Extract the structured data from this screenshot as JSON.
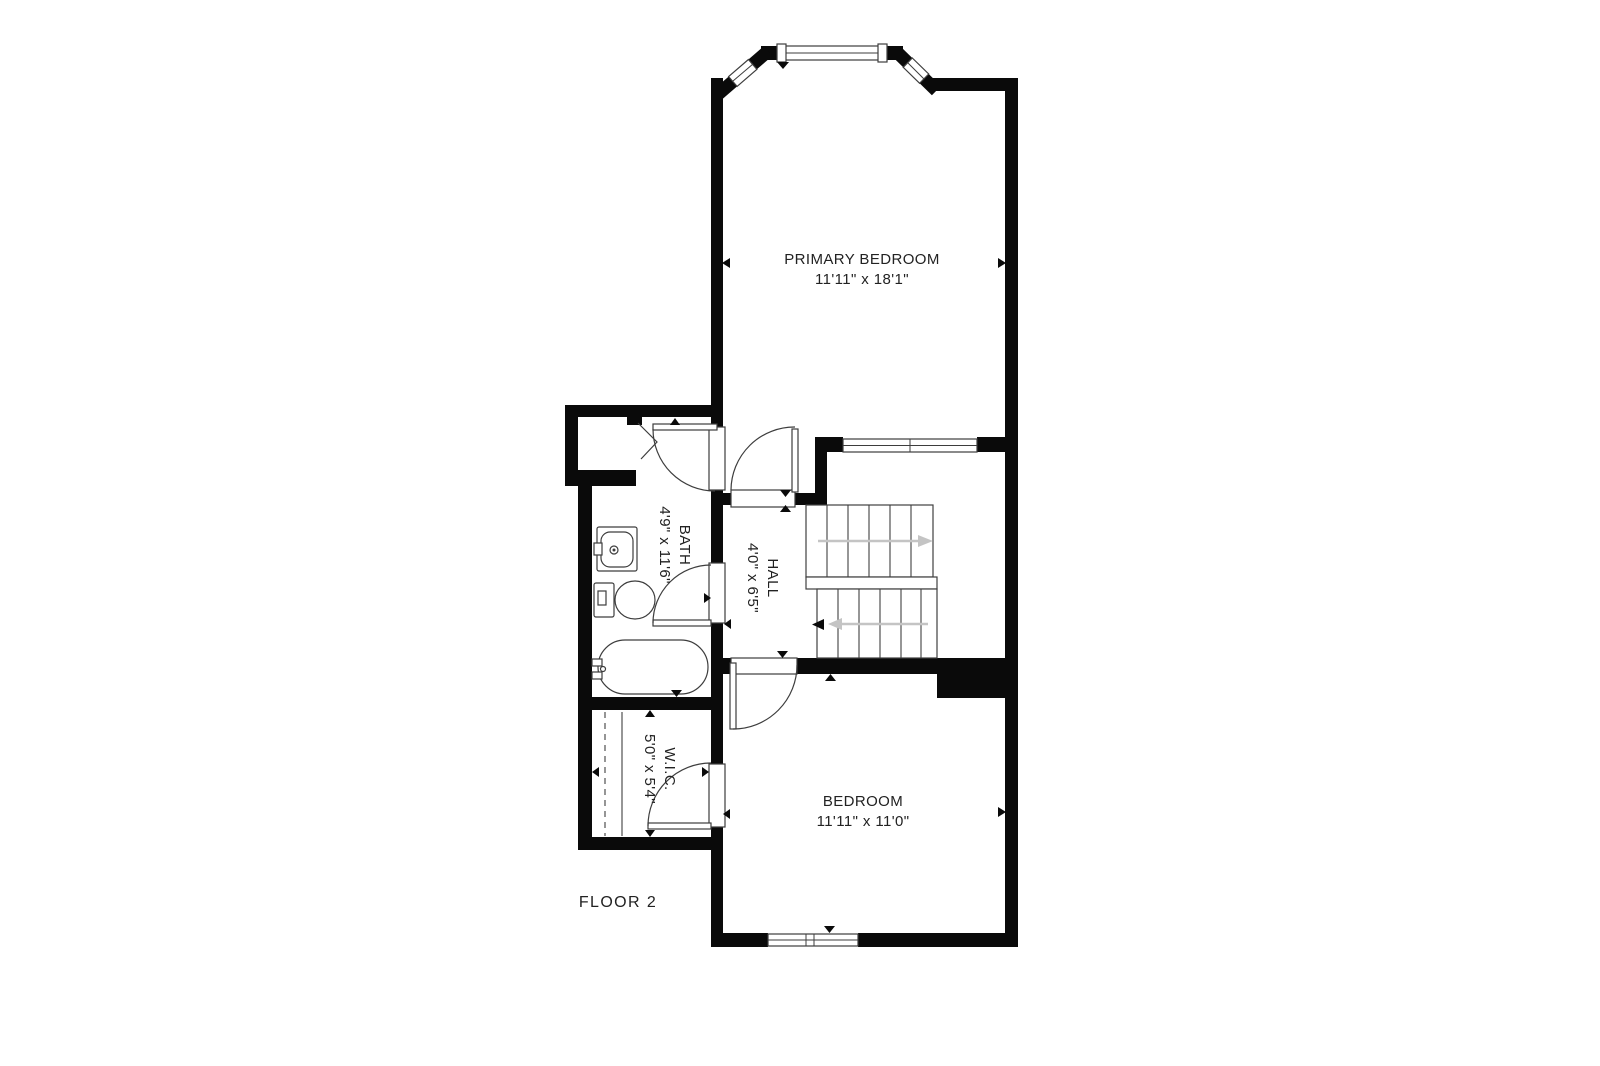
{
  "floor_plan": {
    "floor_label": "FLOOR 2",
    "rooms": {
      "primary_bedroom": {
        "name": "PRIMARY BEDROOM",
        "dimensions": "11'11\" x 18'1\""
      },
      "bath": {
        "name": "BATH",
        "dimensions": "4'9\" x 11'6\""
      },
      "hall": {
        "name": "HALL",
        "dimensions": "4'0\" x 6'5\""
      },
      "wic": {
        "name": "W.I.C.",
        "dimensions": "5'0\" x 5'4\""
      },
      "bedroom": {
        "name": "BEDROOM",
        "dimensions": "11'11\" x 11'0\""
      }
    },
    "colors": {
      "walls": "#0a0a0a",
      "fixture_stroke": "#3d3d3d",
      "stair_arrow": "#c4c4c4",
      "text": "#222222",
      "background": "#ffffff"
    }
  }
}
